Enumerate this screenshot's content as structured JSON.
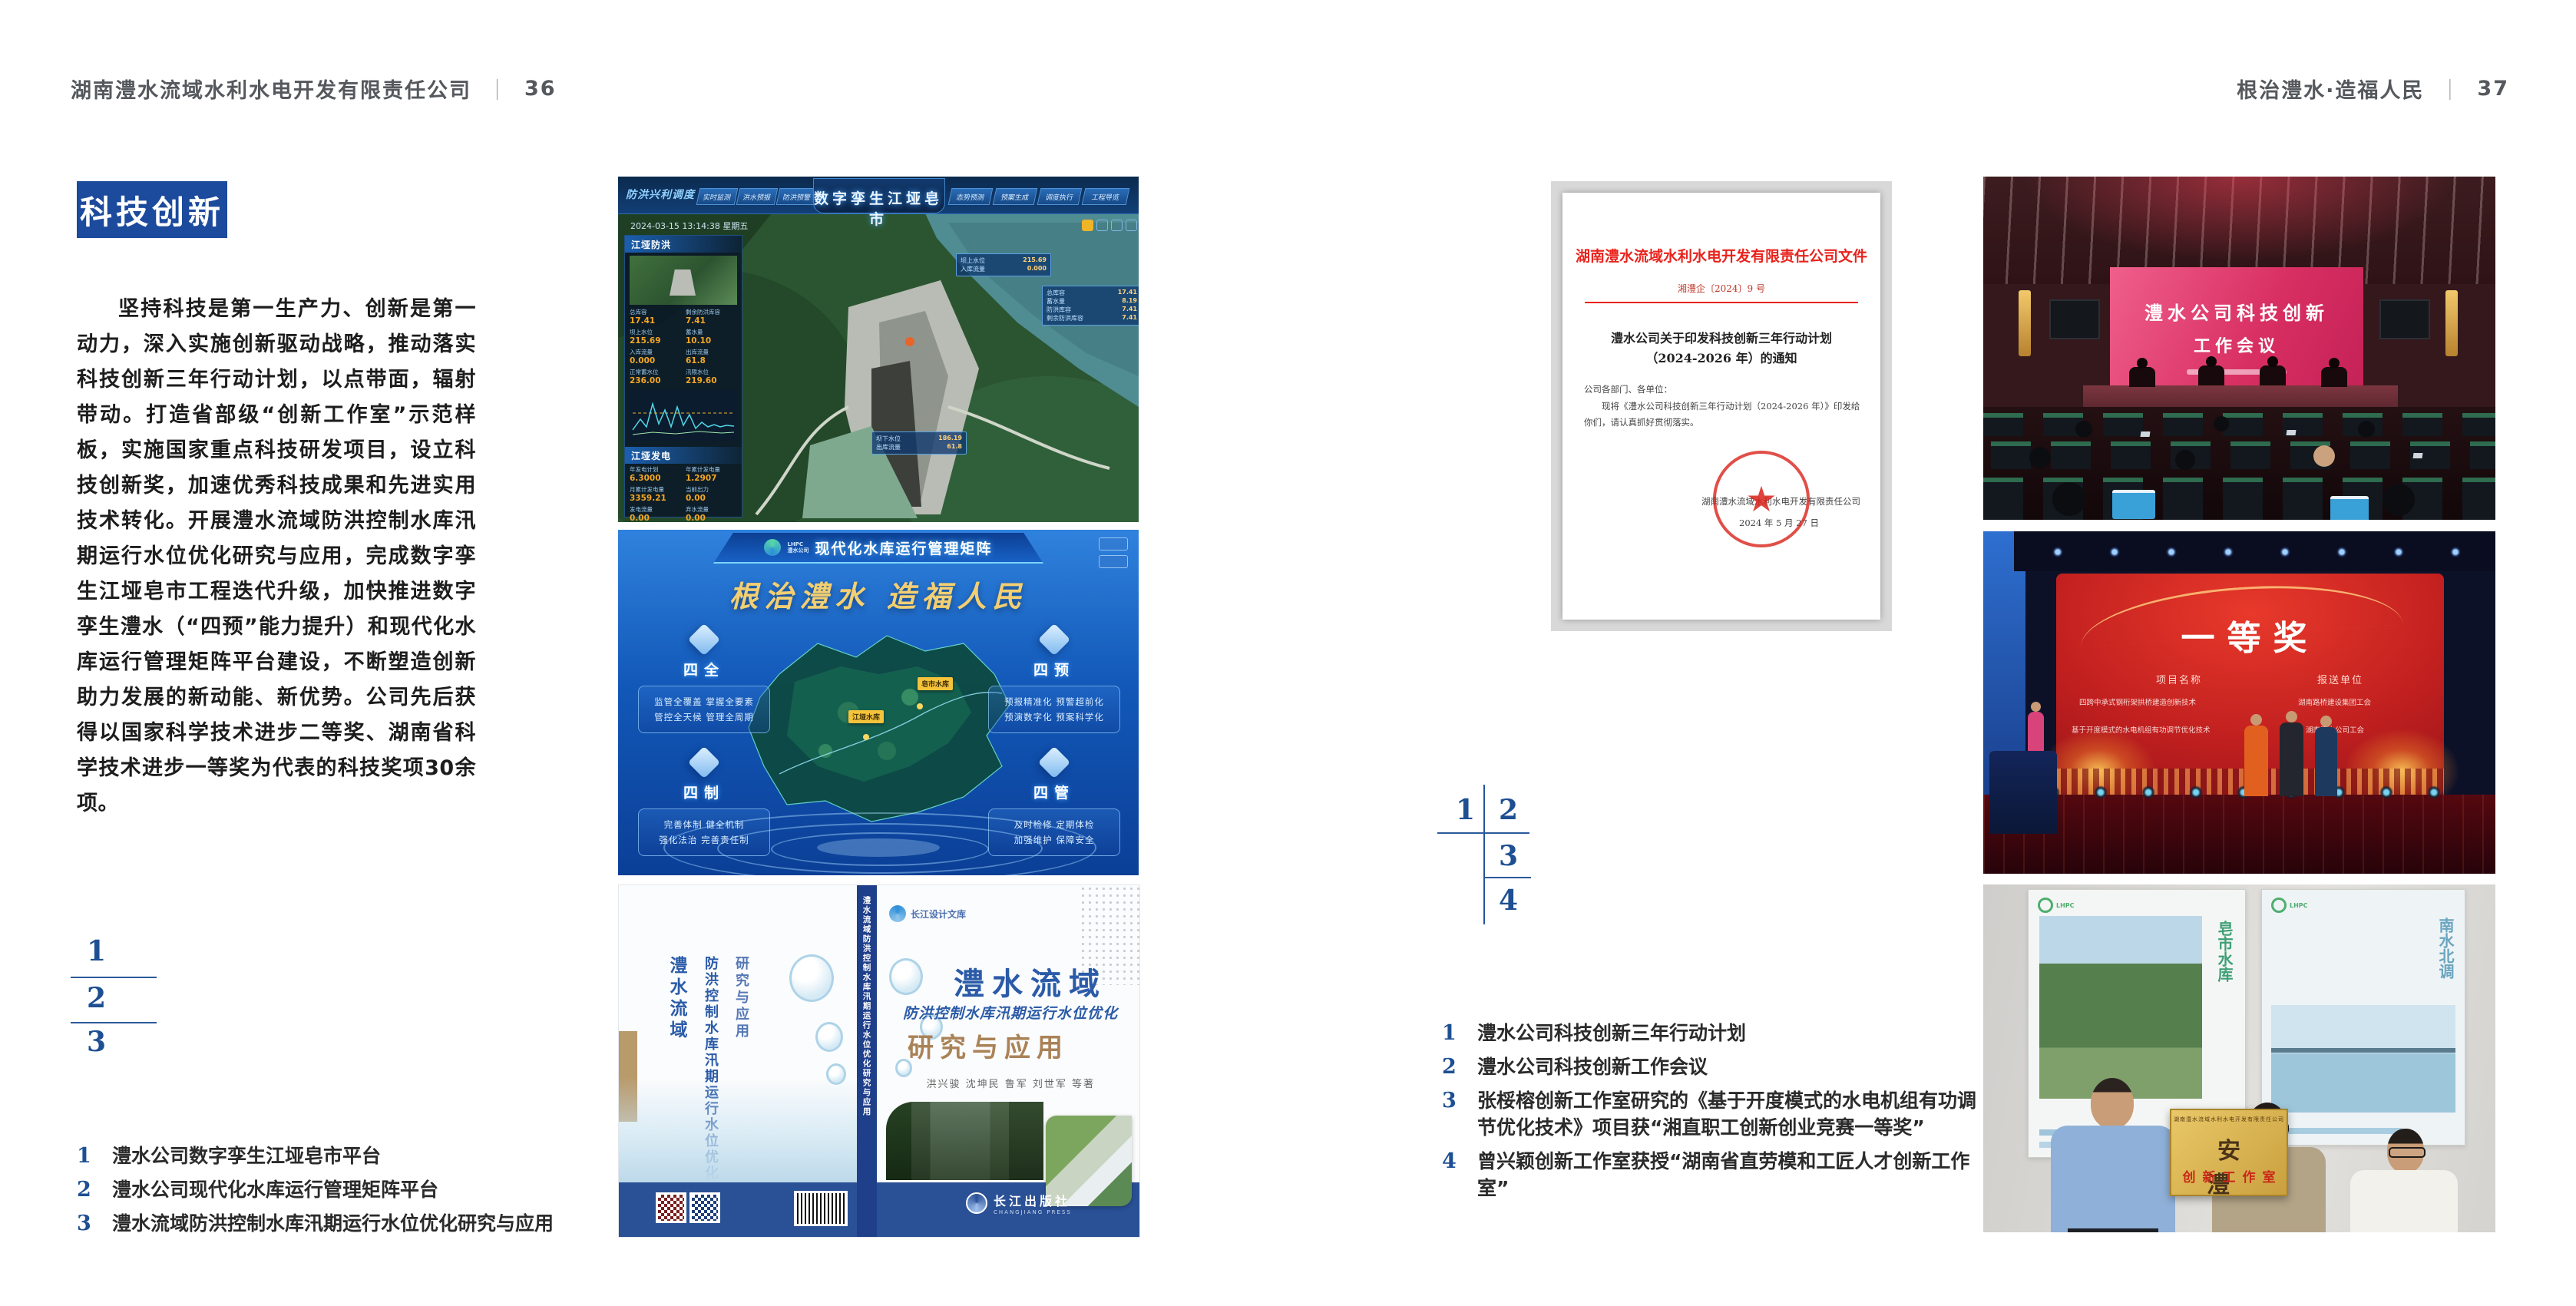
{
  "colors": {
    "accent_blue": "#1c4a9c",
    "number_blue": "#1d4f92",
    "header_gray": "#55585c",
    "doc_red": "#e8231d"
  },
  "lp": {
    "header": {
      "company": "湖南澧水流域水利水电开发有限责任公司",
      "divider": "｜",
      "page": "36"
    },
    "title": "科技创新",
    "body": "坚持科技是第一生产力、创新是第一动力，深入实施创新驱动战略，推动落实科技创新三年行动计划，以点带面，辐射带动。打造省部级“创新工作室”示范样板，实施国家重点科技研发项目，设立科技创新奖，加速优秀科技成果和先进实用技术转化。开展澧水流域防洪控制水库汛期运行水位优化研究与应用，完成数字孪生江垭皂市工程迭代升级，加快推进数字孪生澧水（“四预”能力提升）和现代化水库运行管理矩阵平台建设，不断塑造创新助力发展的新动能、新优势。公司先后获得以国家科学技术进步二等奖、湖南省科学技术进步一等奖为代表的科技奖项30余项。",
    "markers": [
      "1",
      "2",
      "3"
    ],
    "captions": [
      {
        "num": "1",
        "text": "澧水公司数字孪生江垭皂市平台"
      },
      {
        "num": "2",
        "text": "澧水公司现代化水库运行管理矩阵平台"
      },
      {
        "num": "3",
        "text": "澧水流域防洪控制水库汛期运行水位优化研究与应用"
      }
    ],
    "fig1": {
      "corner": "防洪兴利调度",
      "title": "数字孪生江垭皂市",
      "tabs_left": [
        "实时监测",
        "洪水预报",
        "防洪预警"
      ],
      "tabs_right": [
        "态势预测",
        "预案生成",
        "调度执行",
        "工程导览"
      ],
      "datetime": "2024-03-15 13:14:38 星期五",
      "panel1": "江垭防洪",
      "stats": [
        {
          "k": "总库容",
          "v": "17.41"
        },
        {
          "k": "剩余防洪库容",
          "v": "7.41"
        },
        {
          "k": "坝上水位",
          "v": "215.69"
        },
        {
          "k": "蓄水量",
          "v": "10.10"
        },
        {
          "k": "入库流量",
          "v": "0.000"
        },
        {
          "k": "出库流量",
          "v": "61.8"
        },
        {
          "k": "正常蓄水位",
          "v": "236.00"
        },
        {
          "k": "汛限水位",
          "v": "219.60"
        }
      ],
      "panel2": "江垭发电",
      "gen": [
        {
          "k": "年发电计划",
          "v": "6.3000"
        },
        {
          "k": "年累计发电量",
          "v": "1.2907"
        },
        {
          "k": "月累计发电量",
          "v": "3359.21"
        },
        {
          "k": "当前出力",
          "v": "0.00"
        },
        {
          "k": "发电流量",
          "v": "0.00"
        },
        {
          "k": "弃水流量",
          "v": "0.00"
        }
      ],
      "callout1": [
        {
          "k": "坝上水位",
          "v": "215.69"
        },
        {
          "k": "入库流量",
          "v": "0.000"
        }
      ],
      "callout2": [
        {
          "k": "总库容",
          "v": "17.41"
        },
        {
          "k": "蓄水量",
          "v": "8.19"
        },
        {
          "k": "防洪库容",
          "v": "7.41"
        },
        {
          "k": "剩余防洪库容",
          "v": "7.41"
        }
      ],
      "callout3": [
        {
          "k": "坝下水位",
          "v": "186.19"
        },
        {
          "k": "出库流量",
          "v": "61.8"
        }
      ]
    },
    "fig2": {
      "logo_abbr": "LHPC",
      "logo_name": "澧水公司",
      "title": "现代化水库运行管理矩阵",
      "slogan": "根治澧水 造福人民",
      "tags": [
        "皂市水库",
        "江垭水库"
      ],
      "quadrants": [
        {
          "name": "四全",
          "l1": "监管全覆盖 掌握全要素",
          "l2": "管控全天候 管理全周期"
        },
        {
          "name": "四预",
          "l1": "预报精准化 预警超前化",
          "l2": "预演数字化 预案科学化"
        },
        {
          "name": "四制",
          "l1": "完善体制 健全机制",
          "l2": "强化法治 完善责任制"
        },
        {
          "name": "四管",
          "l1": "及时检修 定期体检",
          "l2": "加强维护 保障安全"
        }
      ]
    },
    "fig3": {
      "badge": "长江设计文库",
      "t1": "澧水流域",
      "t2": "防洪控制水库汛期运行水位优化",
      "t3": "研究与应用",
      "authors": "洪兴骏 沈坤民 鲁军 刘世军 等著",
      "spine": "澧水流域防洪控制水库汛期运行水位优化研究与应用",
      "publisher": "长江出版社",
      "publisher_en": "CHANGJIANG PRESS"
    }
  },
  "rp": {
    "header": {
      "title": "根治澧水·造福人民",
      "divider": "｜",
      "page": "37"
    },
    "markers": [
      "1",
      "2",
      "3",
      "4"
    ],
    "captions": [
      {
        "num": "1",
        "text": "澧水公司科技创新三年行动计划"
      },
      {
        "num": "2",
        "text": "澧水公司科技创新工作会议"
      },
      {
        "num": "3",
        "text": "张桵榕创新工作室研究的《基于开度模式的水电机组有功调节优化技术》项目获“湘直职工创新创业竞赛一等奖”"
      },
      {
        "num": "4",
        "text": "曾兴颖创新工作室获授“湖南省直劳模和工匠人才创新工作室”"
      }
    ],
    "doc": {
      "letterhead": "湖南澧水流域水利水电开发有限责任公司文件",
      "number": "湘澧企〔2024〕9 号",
      "title1": "澧水公司关于印发科技创新三年行动计划",
      "title2": "（2024-2026 年）的通知",
      "salutation": "公司各部门、各单位：",
      "body": "现将《澧水公司科技创新三年行动计划（2024-2026 年）》印发给你们，请认真抓好贯彻落实。",
      "signer": "湖南澧水流域水利水电开发有限责任公司",
      "date": "2024 年 5 月 27 日"
    },
    "meeting": {
      "line1": "澧水公司科技创新",
      "line2": "工作会议"
    },
    "award": {
      "title": "一等奖",
      "col1": "项目名称",
      "col2": "报送单位",
      "c1r1": "四跨中承式钢桁架拱桥建造创新技术",
      "c1r2": "基于开度模式的水电机组有功调节优化技术",
      "c2r1": "湖南路桥建设集团工会",
      "c2r2": "湖南澧水公司工会"
    },
    "plaque": {
      "org": "湖南澧水流域水利水电开发有限责任公司",
      "main": "安 澧",
      "sub": "创新工作室",
      "poster_left": "皂市水库",
      "poster_right": "南水北调"
    }
  }
}
